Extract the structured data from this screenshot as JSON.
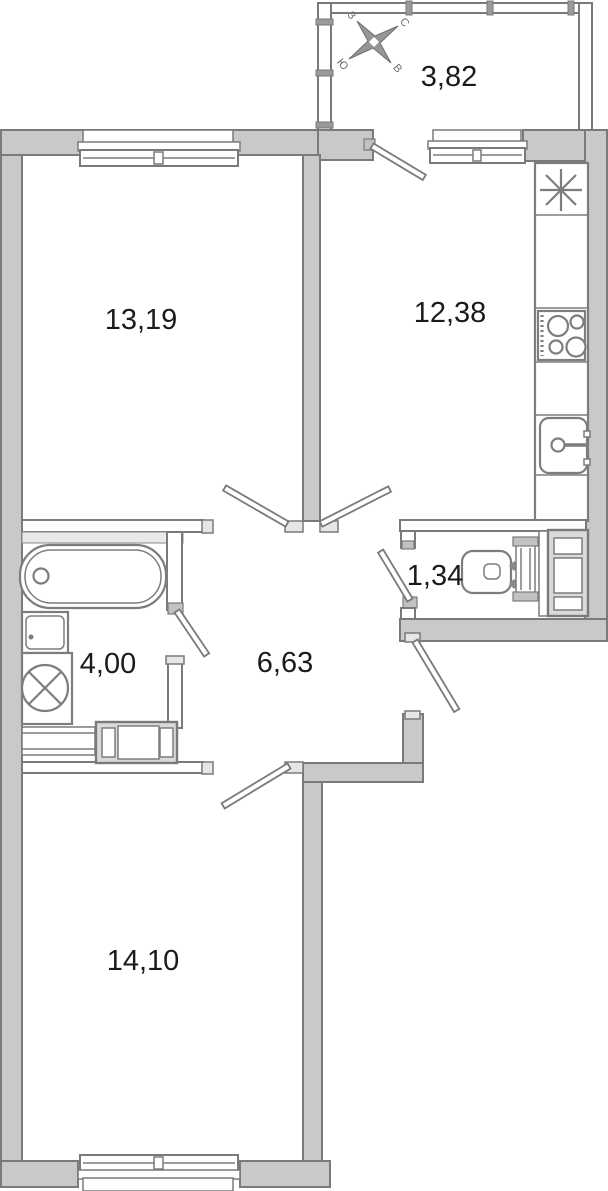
{
  "floorplan": {
    "labels": {
      "balcony": "3,82",
      "living_room": "13,19",
      "kitchen": "12,38",
      "wc": "1,34",
      "bathroom": "4,00",
      "hallway": "6,63",
      "bedroom": "14,10"
    },
    "compass": {
      "north": "С",
      "east": "В",
      "south": "Ю",
      "west": "З"
    },
    "colors": {
      "wall_fill": "#c9c9c9",
      "wall_stroke": "#7a7a7a",
      "fixture_stroke": "#7d7d7d",
      "label": "#1b1b1b",
      "compass_fill": "#969696"
    }
  }
}
